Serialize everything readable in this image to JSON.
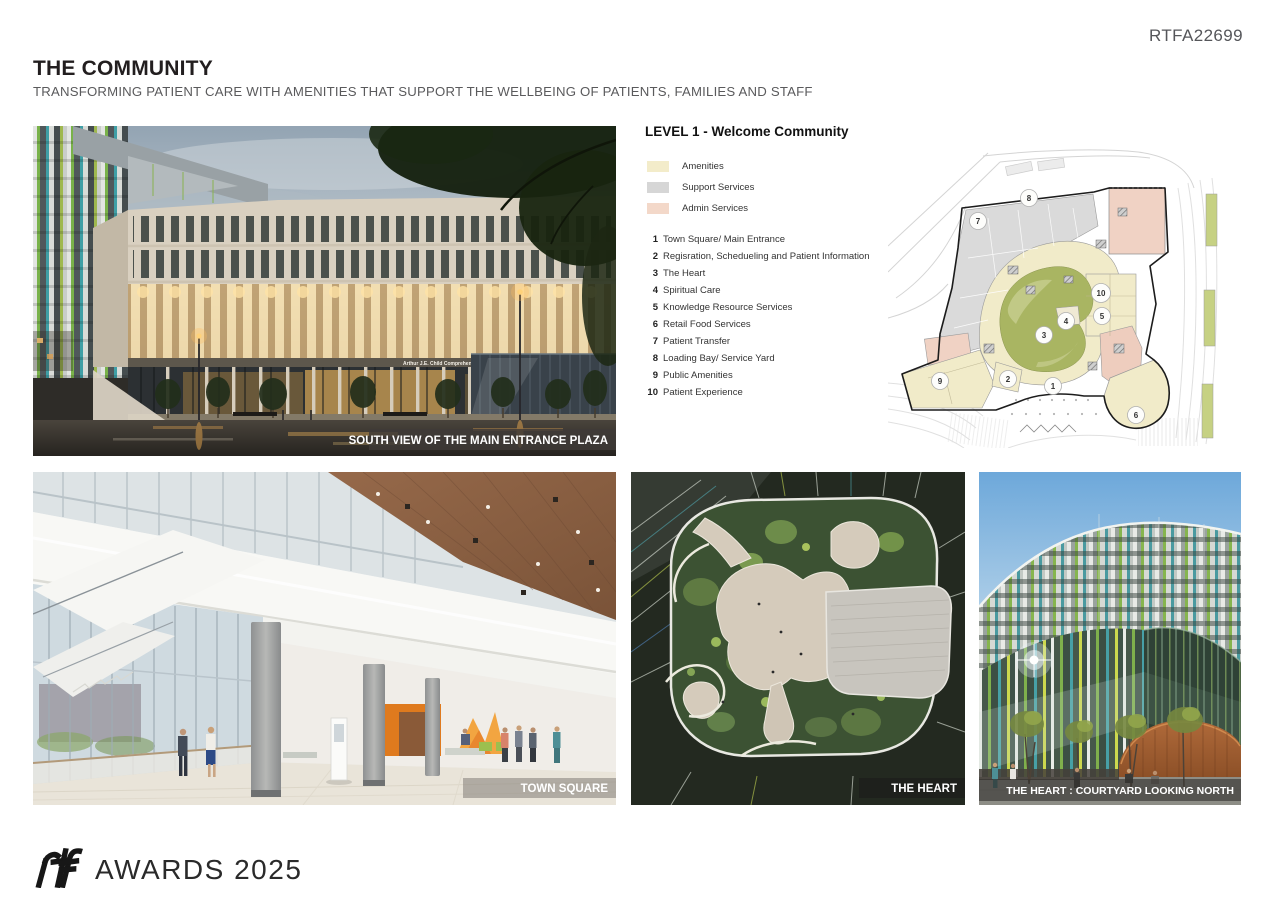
{
  "header": {
    "submission_id": "RTFA22699",
    "title": "THE COMMUNITY",
    "subtitle": "TRANSFORMING PATIENT CARE WITH AMENITIES THAT SUPPORT THE WELLBEING OF PATIENTS, FAMILIES AND STAFF"
  },
  "plan_panel": {
    "heading": "LEVEL 1 - Welcome Community",
    "legend": [
      {
        "label": "Amenities",
        "color": "#f3ecca"
      },
      {
        "label": "Support Services",
        "color": "#d6d6d6"
      },
      {
        "label": "Admin Services",
        "color": "#f3d8c9"
      }
    ],
    "key_items": [
      {
        "num": "1",
        "label": "Town Square/ Main Entrance"
      },
      {
        "num": "2",
        "label": "Regisration, Schedueling and Patient Information"
      },
      {
        "num": "3",
        "label": "The Heart"
      },
      {
        "num": "4",
        "label": "Spiritual Care"
      },
      {
        "num": "5",
        "label": "Knowledge Resource Services"
      },
      {
        "num": "6",
        "label": "Retail Food Services"
      },
      {
        "num": "7",
        "label": "Patient Transfer"
      },
      {
        "num": "8",
        "label": "Loading Bay/ Service Yard"
      },
      {
        "num": "9",
        "label": "Public Amenities"
      },
      {
        "num": "10",
        "label": "Patient Experience"
      }
    ],
    "markers": [
      {
        "num": "1",
        "x": 165,
        "y": 238
      },
      {
        "num": "2",
        "x": 120,
        "y": 231
      },
      {
        "num": "3",
        "x": 156,
        "y": 187
      },
      {
        "num": "4",
        "x": 178,
        "y": 173
      },
      {
        "num": "5",
        "x": 214,
        "y": 168
      },
      {
        "num": "6",
        "x": 248,
        "y": 267
      },
      {
        "num": "7",
        "x": 90,
        "y": 73
      },
      {
        "num": "8",
        "x": 141,
        "y": 50
      },
      {
        "num": "9",
        "x": 52,
        "y": 233
      },
      {
        "num": "10",
        "x": 213,
        "y": 145
      }
    ]
  },
  "photos": {
    "main": {
      "caption": "SOUTH VIEW OF THE MAIN ENTRANCE PLAZA",
      "building_sign": "Arthur J.E. Child Comprehensive Cancer Centre"
    },
    "town_square": {
      "caption": "TOWN SQUARE"
    },
    "heart_aerial": {
      "caption": "THE HEART"
    },
    "heart_courtyard": {
      "caption": "THE HEART : COURTYARD LOOKING NORTH"
    }
  },
  "footer": {
    "brand": "rtf",
    "label": "AWARDS 2025"
  }
}
